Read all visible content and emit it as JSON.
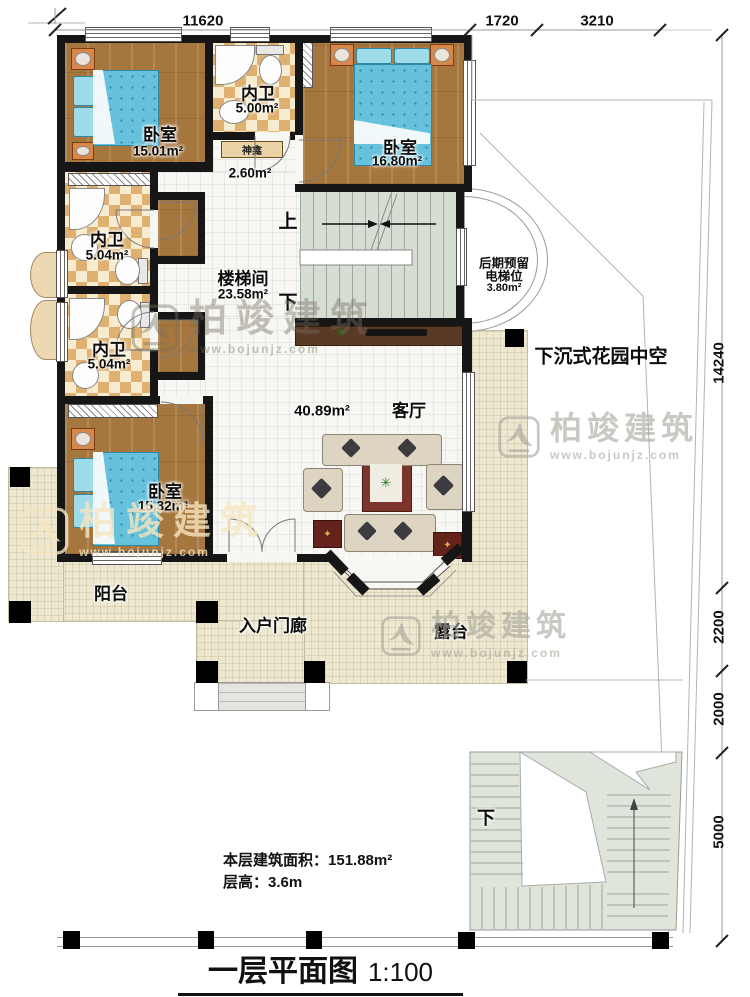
{
  "title": {
    "text": "一层平面图",
    "scale": "1:100"
  },
  "notes": {
    "area_label": "本层建筑面积：",
    "area_value": "151.88m²",
    "height_label": "层高：",
    "height_value": "3.6m"
  },
  "dimensions": {
    "top": [
      "11620",
      "1720",
      "3210"
    ],
    "right": [
      "14240",
      "2200",
      "2000",
      "5000"
    ]
  },
  "rooms": {
    "bedroom_tl": {
      "name": "卧室",
      "area": "15.01m²"
    },
    "bath_top": {
      "name": "内卫",
      "area": "5.00m²"
    },
    "shrine": {
      "name": "神龛",
      "area": "2.60m²"
    },
    "bedroom_tr": {
      "name": "卧室",
      "area": "16.80m²"
    },
    "stairwell": {
      "name": "楼梯间",
      "area": "23.58m²"
    },
    "bath_mid": {
      "name": "内卫",
      "area": "5.04m²"
    },
    "bath_low": {
      "name": "内卫",
      "area": "5.04m²"
    },
    "bedroom_bl": {
      "name": "卧室",
      "area": "15.32m²"
    },
    "living": {
      "name": "客厅",
      "area": "40.89m²"
    },
    "elevator": {
      "line1": "后期预留",
      "line2": "电梯位",
      "area": "3.80m²"
    },
    "garden": {
      "name": "下沉式花园中空"
    },
    "balcony": {
      "name": "阳台"
    },
    "porch": {
      "name": "入户门廊"
    },
    "terrace": {
      "name": "露台"
    }
  },
  "markers": {
    "up": "上",
    "down_stair": "下",
    "down_garden": "下"
  },
  "watermark": {
    "brand": "柏竣建筑",
    "url": "www.bojunjz.com"
  }
}
